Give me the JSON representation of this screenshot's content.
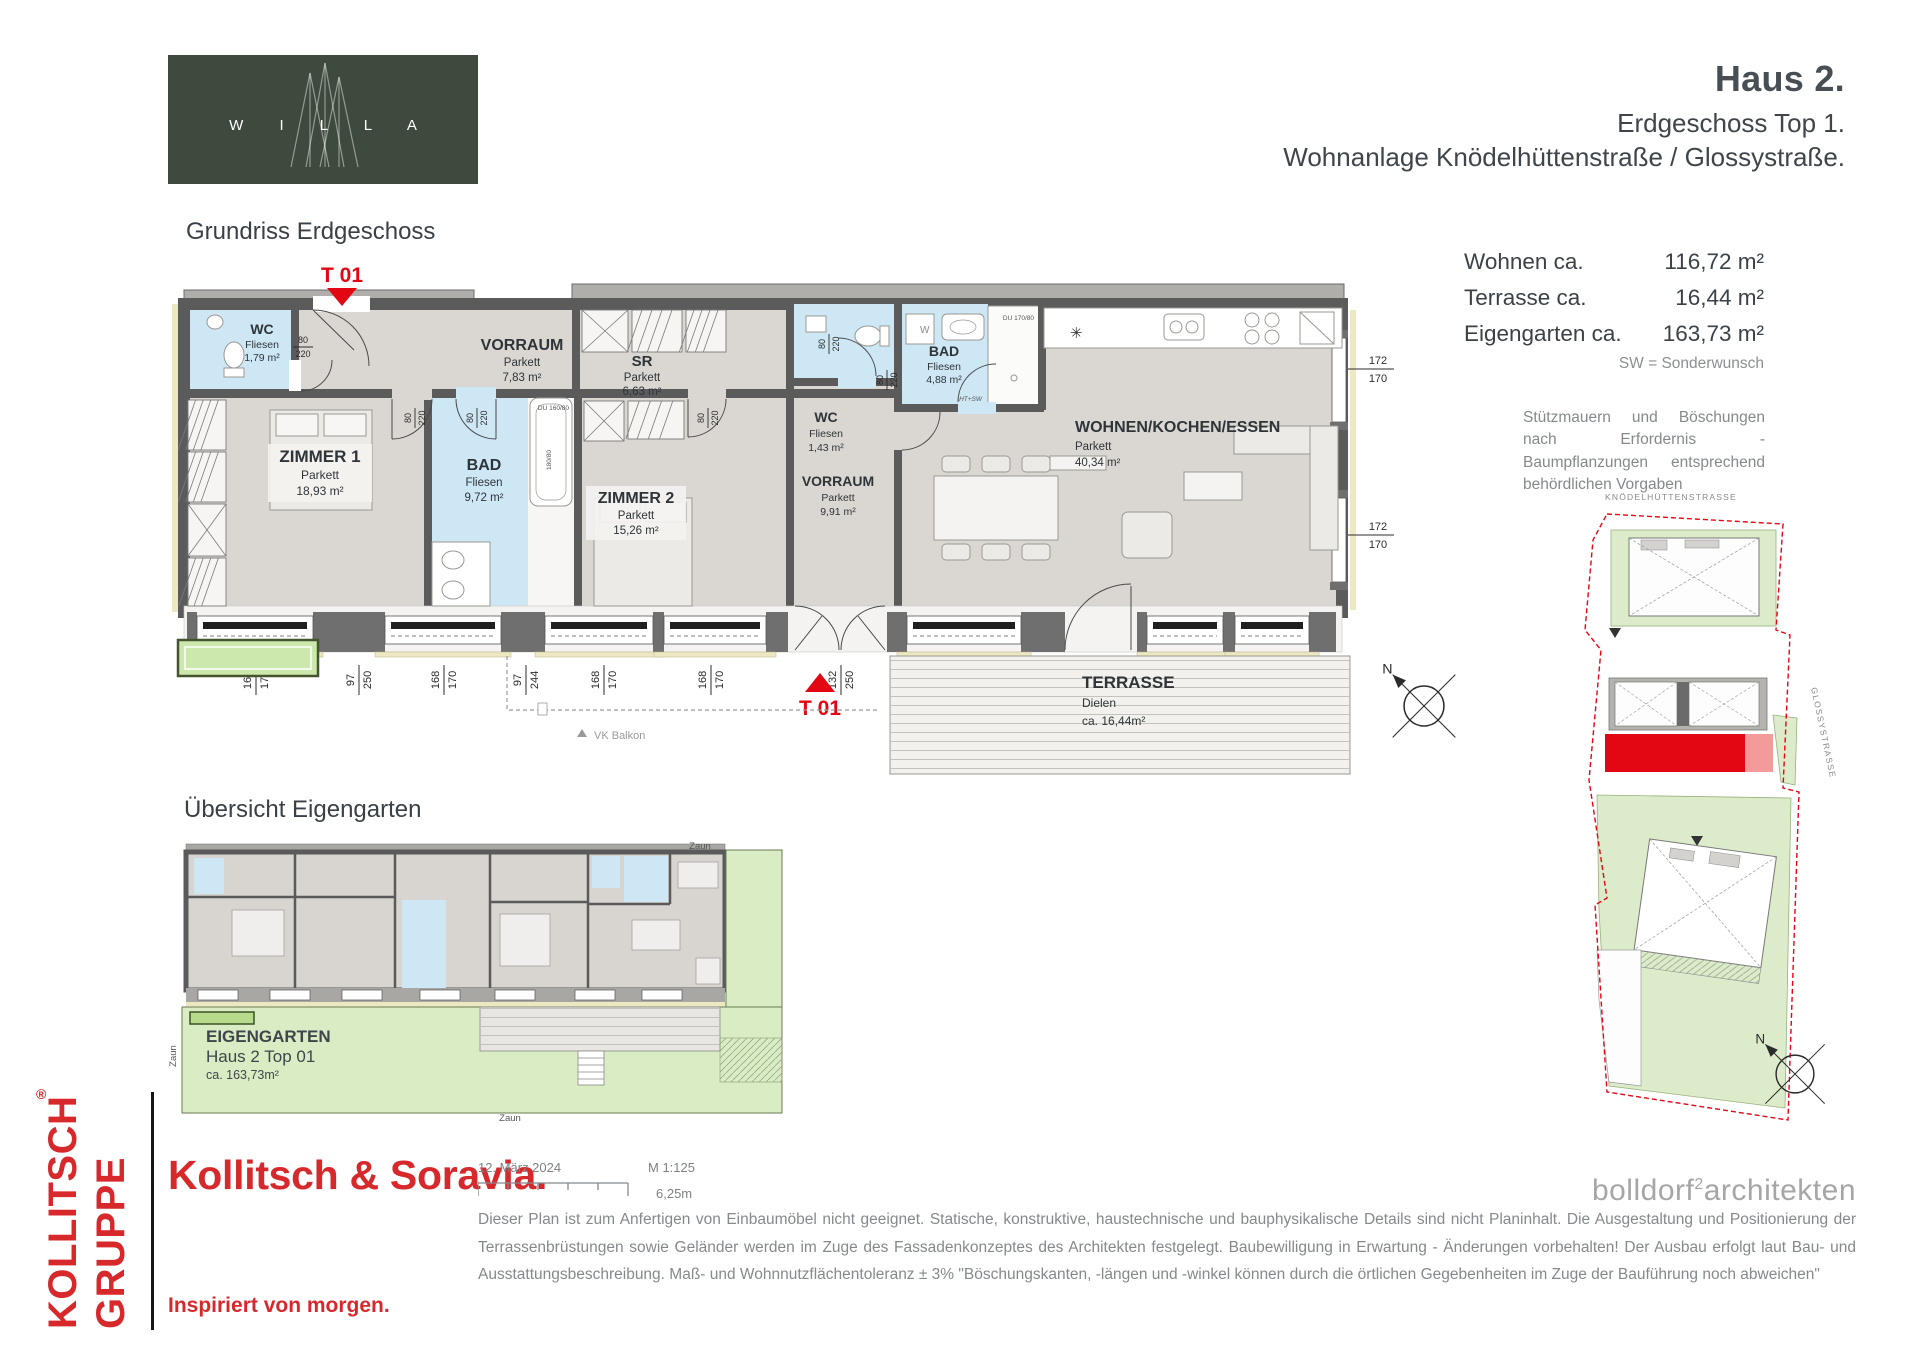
{
  "colors": {
    "brand_red": "#d7282c",
    "plan_red": "#e30613",
    "wall": "#5b5b5b",
    "room_gray": "#dad7d2",
    "wet_blue": "#cde7f5",
    "garden_green": "#d9ecc4",
    "logo_green": "#3d4a3d"
  },
  "logo": {
    "letters": "W I L L A"
  },
  "header": {
    "title": "Haus 2.",
    "subtitle": "Erdgeschoss Top 1.",
    "project": "Wohnanlage Knödelhüttenstraße / Glossystraße."
  },
  "plan": {
    "section_title": "Grundriss Erdgeschoss",
    "entrance_marker": "T 01",
    "terrace_marker": "T 01",
    "vk_balkon": "VK Balkon",
    "north": "N",
    "rooms": [
      {
        "name": "WC",
        "floor": "Fliesen",
        "area": "1,79 m²"
      },
      {
        "name": "ZIMMER 1",
        "floor": "Parkett",
        "area": "18,93 m²"
      },
      {
        "name": "VORRAUM",
        "floor": "Parkett",
        "area": "7,83 m²"
      },
      {
        "name": "SR",
        "floor": "Parkett",
        "area": "6,63 m²"
      },
      {
        "name": "BAD",
        "floor": "Fliesen",
        "area": "9,72 m²"
      },
      {
        "name": "ZIMMER 2",
        "floor": "Parkett",
        "area": "15,26 m²"
      },
      {
        "name": "WC",
        "floor": "Fliesen",
        "area": "1,43 m²"
      },
      {
        "name": "BAD",
        "floor": "Fliesen",
        "area": "4,88 m²"
      },
      {
        "name": "WOHNEN/KOCHEN/ESSEN",
        "floor": "Parkett",
        "area": "40,34 m²"
      },
      {
        "name": "VORRAUM",
        "floor": "Parkett",
        "area": "9,91 m²"
      }
    ],
    "terrace": {
      "name": "TERRASSE",
      "floor": "Dielen",
      "area": "ca. 16,44m²"
    },
    "door_label": {
      "w": "80",
      "h": "220"
    },
    "fixture_labels": {
      "du160": "DU 160/80",
      "du170": "DU 170/80",
      "tub": "180/80",
      "washer": "W",
      "ht_sw": "HT+SW"
    },
    "dims_bottom": [
      {
        "t": "168",
        "b": "170"
      },
      {
        "t": "97",
        "b": "250"
      },
      {
        "t": "168",
        "b": "170"
      },
      {
        "t": "97",
        "b": "244"
      },
      {
        "t": "168",
        "b": "170"
      },
      {
        "t": "168",
        "b": "170"
      },
      {
        "t": "132",
        "b": "250"
      },
      {
        "t": "170",
        "b": "170"
      },
      {
        "t": "112",
        "b": "250"
      },
      {
        "t": "116",
        "b": "170"
      },
      {
        "t": "116",
        "b": "170"
      }
    ],
    "dims_right": [
      {
        "t": "172",
        "b": "170"
      },
      {
        "t": "172",
        "b": "170"
      }
    ]
  },
  "areas": {
    "rows": [
      {
        "label": "Wohnen ca.",
        "value": "116,72 m²"
      },
      {
        "label": "Terrasse ca.",
        "value": "16,44 m²"
      },
      {
        "label": "Eigengarten ca.",
        "value": "163,73 m²"
      }
    ],
    "legend": "SW = Sonderwunsch"
  },
  "site_note": "Stützmauern und Böschungen nach Erfordernis - Baumpflanzungen entsprechend behördlichen Vorgaben",
  "garden": {
    "section_title": "Übersicht Eigengarten",
    "name": "EIGENGARTEN",
    "unit": "Haus 2 Top 01",
    "area": "ca. 163,73m²",
    "fence": "Zaun"
  },
  "siteplan": {
    "street_top": "KNÖDELHÜTTENSTRASSE",
    "street_right": "GLOSSYSTRASSE",
    "north": "N"
  },
  "footer": {
    "group_top": "KOLLITSCH",
    "reg": "®",
    "group_bottom": "GRUPPE",
    "brand": "Kollitsch & Soravia.",
    "slogan": "Inspiriert von morgen.",
    "date": "12. März 2024",
    "scale": "M 1:125",
    "scale_len": "6,25m",
    "architect_a": "bolldorf",
    "architect_sup": "2",
    "architect_b": "architekten",
    "disclaimer": "Dieser Plan ist zum Anfertigen von Einbaumöbel nicht geeignet. Statische, konstruktive, haustechnische und bauphysikalische Details sind nicht Planinhalt. Die Ausgestaltung und Positionierung der Terrassenbrüstungen sowie Geländer werden im Zuge des Fassadenkonzeptes des Architekten festgelegt. Baubewilligung in Erwartung - Änderungen vorbehalten! Der Ausbau erfolgt laut Bau- und Ausstattungsbeschreibung. Maß- und Wohnnutzflächentoleranz ± 3% \"Böschungskanten, -längen und -winkel können durch die örtlichen Gegebenheiten im Zuge der Bauführung noch abweichen\""
  }
}
